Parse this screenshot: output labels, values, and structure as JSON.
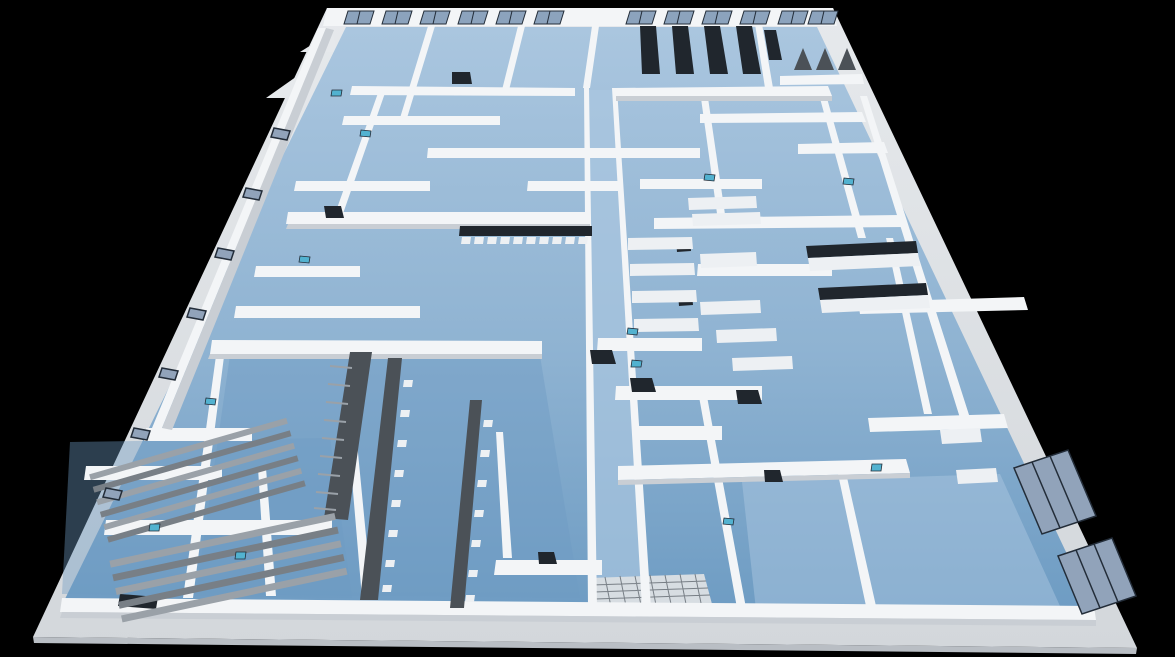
{
  "meta": {
    "title": "3D architectural floor plan render — laboratory storey, aerial perspective on black background"
  },
  "scene": {
    "colors": {
      "background": "#000000",
      "slab_edge": "#e6e9ec",
      "slab_side": "#b9bec4",
      "wall_top": "#f3f5f7",
      "wall_face": "#c9ced4",
      "floor_light": "#aac6df",
      "floor_mid": "#8fb3d2",
      "floor_dark": "#6e9cc3",
      "dark_equipment": "#20262d",
      "counter_dark": "#4b5157",
      "slat_light": "#9aa1a8",
      "slat_dark": "#787f86",
      "bench_white": "#edf0f3",
      "grid_patch": "#d7dde2",
      "window_glass": "#8ca3bd",
      "side_window": "#91a3ba",
      "interior_window": "#52b2d0",
      "window_frame": "#232d39"
    },
    "elements": {
      "building": "single storey cutaway model, walls white, floors light blue",
      "central_corridor": "corridor running from front edge to back wall",
      "back_wall_window_count": 12,
      "side_wall_window_count": 2,
      "left_wall_window_count": 7,
      "interior_window_count": 12,
      "server_rack_count": 5,
      "acoustic_wedge_count": 3,
      "long_lab_bench_count": 2,
      "seating_row_blocks": 2
    }
  }
}
